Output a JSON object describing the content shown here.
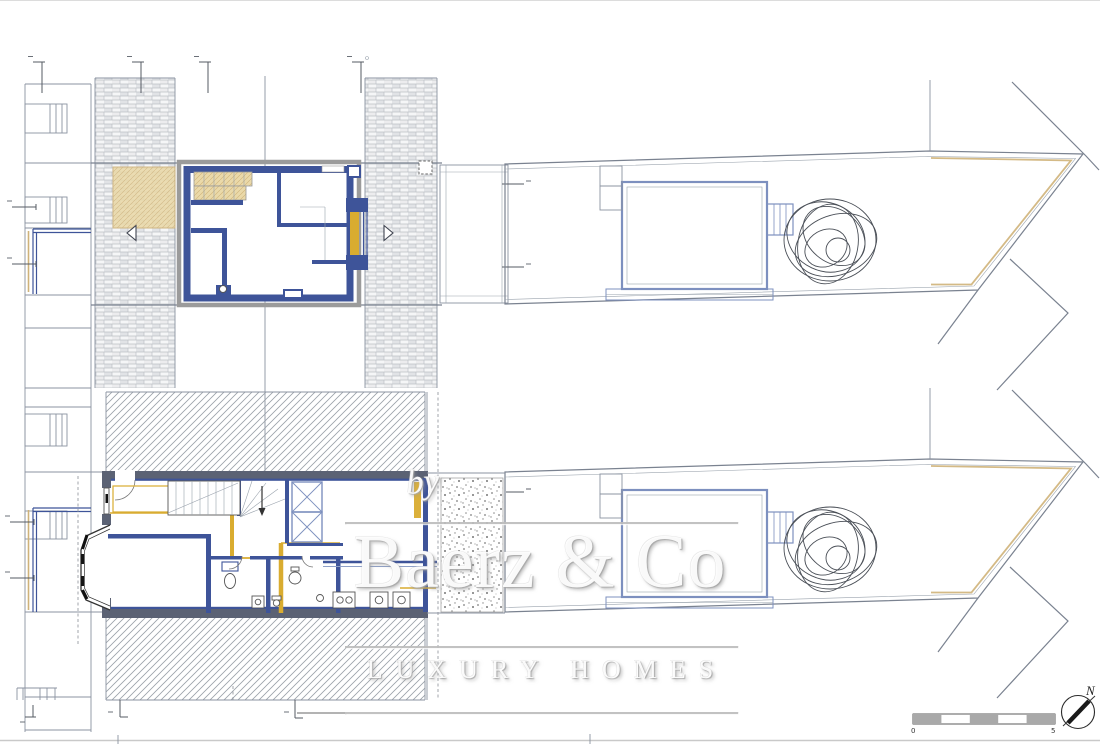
{
  "watermark": {
    "prefix": "by",
    "brand": "Baerz & Co",
    "tagline": "LUXURY HOMES"
  },
  "scale_bar": {
    "start_label": "0",
    "end_label": "5",
    "segments": 5
  },
  "compass": {
    "icon": "north-arrow-compass",
    "north_label": "N"
  },
  "drawing": {
    "sheets": [
      {
        "name": "upper-floor-plan-with-roof",
        "features": [
          "brick-roof-bands",
          "roof-terrace",
          "bedroom",
          "dormer-window",
          "stairs"
        ]
      },
      {
        "name": "ground-floor-plan",
        "features": [
          "neighbor-hatch-bands",
          "entry",
          "stairs",
          "bathroom",
          "kitchen",
          "bay-window",
          "gravel-patio"
        ]
      },
      {
        "name": "site-plan",
        "features": [
          "garden-structure",
          "tree",
          "plot-boundary"
        ]
      }
    ]
  },
  "colors": {
    "wall_blue": "#3e5499",
    "site_blue": "#7d90bf",
    "accent_yellow": "#d9ac30",
    "tan_fill": "#ead9a9",
    "tan_line": "#cfb279",
    "wall_gray": "#5b6274",
    "frame_gray": "#9b9b9b",
    "line_gray": "#8b93a1",
    "hatch_gray": "#9aa1a9",
    "brick_line": "#bcc0c5",
    "paper": "#ffffff",
    "watermark_shadow": "#a8a8a8"
  }
}
